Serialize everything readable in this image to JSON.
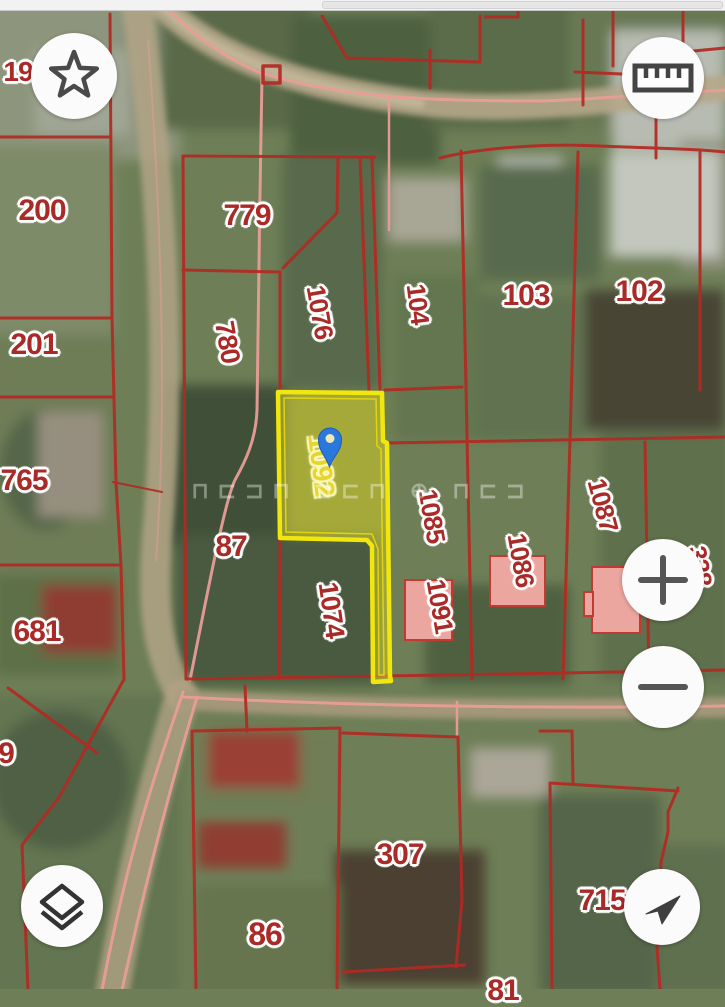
{
  "statusbar": {
    "note": ""
  },
  "map": {
    "watermark": "⊓⊏⊐⊓  ⊐⊏⊓  ⊕  ⊓⊏⊐",
    "selected_parcel": {
      "number": "1092",
      "fill_color": "#ded628",
      "border_color": "#f2e70c",
      "pin_color": "#2b78dd"
    },
    "colors": {
      "boundary_red": "#b22a23",
      "road_line_pink": "#e89d97",
      "label_red": "#a92a26",
      "building_pink": "#eca6a0"
    },
    "labels": [
      {
        "text": "200",
        "x": 42,
        "y": 211,
        "rot": 0,
        "size": 30
      },
      {
        "text": "201",
        "x": 34,
        "y": 345,
        "rot": 0,
        "size": 30
      },
      {
        "text": "765",
        "x": 24,
        "y": 481,
        "rot": 0,
        "size": 30
      },
      {
        "text": "681",
        "x": 37,
        "y": 632,
        "rot": 0,
        "size": 30
      },
      {
        "text": "9",
        "x": 6,
        "y": 754,
        "rot": 0,
        "size": 30
      },
      {
        "text": "19",
        "x": 18,
        "y": 72,
        "rot": 0,
        "size": 28
      },
      {
        "text": "779",
        "x": 247,
        "y": 216,
        "rot": 0,
        "size": 30
      },
      {
        "text": "780",
        "x": 227,
        "y": 342,
        "rot": 80,
        "size": 27
      },
      {
        "text": "1076",
        "x": 320,
        "y": 312,
        "rot": 80,
        "size": 26
      },
      {
        "text": "104",
        "x": 418,
        "y": 304,
        "rot": 83,
        "size": 26
      },
      {
        "text": "103",
        "x": 526,
        "y": 296,
        "rot": 0,
        "size": 30
      },
      {
        "text": "102",
        "x": 639,
        "y": 292,
        "rot": 0,
        "size": 30
      },
      {
        "text": "1085",
        "x": 432,
        "y": 516,
        "rot": 80,
        "size": 26
      },
      {
        "text": "1091",
        "x": 440,
        "y": 606,
        "rot": 80,
        "size": 26
      },
      {
        "text": "1086",
        "x": 521,
        "y": 560,
        "rot": 80,
        "size": 26
      },
      {
        "text": "1087",
        "x": 603,
        "y": 505,
        "rot": 75,
        "size": 26
      },
      {
        "text": "328",
        "x": 700,
        "y": 566,
        "rot": 80,
        "size": 26
      },
      {
        "text": "1074",
        "x": 331,
        "y": 610,
        "rot": 82,
        "size": 27
      },
      {
        "text": "87",
        "x": 231,
        "y": 547,
        "rot": 0,
        "size": 30
      },
      {
        "text": "86",
        "x": 265,
        "y": 934,
        "rot": 0,
        "size": 32
      },
      {
        "text": "307",
        "x": 400,
        "y": 855,
        "rot": 0,
        "size": 30
      },
      {
        "text": "715",
        "x": 602,
        "y": 901,
        "rot": 0,
        "size": 30
      },
      {
        "text": "81",
        "x": 503,
        "y": 991,
        "rot": 0,
        "size": 30
      }
    ]
  },
  "controls": {
    "star": {
      "icon": "star-icon"
    },
    "ruler": {
      "icon": "ruler-icon"
    },
    "zoom_in": {
      "icon": "plus-icon"
    },
    "zoom_out": {
      "icon": "minus-icon"
    },
    "layers": {
      "icon": "layers-icon"
    },
    "compass": {
      "icon": "navigation-arrow-icon"
    }
  }
}
